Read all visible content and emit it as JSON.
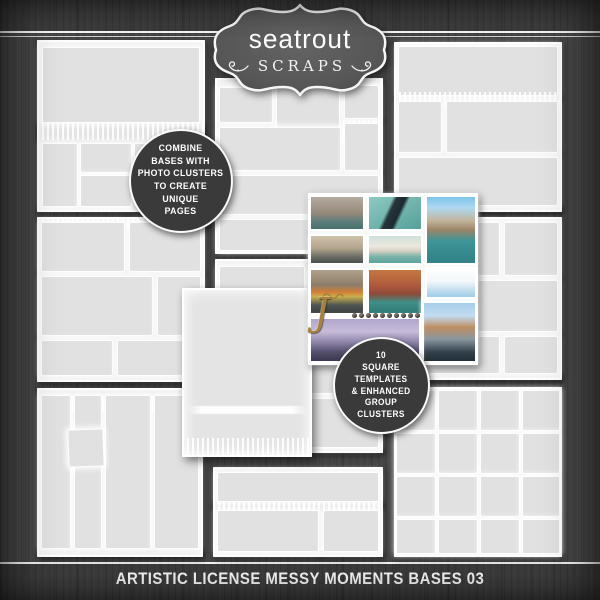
{
  "brand": {
    "name": "seatrout",
    "subname": "SCRAPS"
  },
  "callouts": {
    "left": {
      "lines": [
        "COMBINE",
        "BASES WITH",
        "PHOTO CLUSTERS",
        "TO CREATE",
        "UNIQUE",
        "PAGES"
      ]
    },
    "right": {
      "lines": [
        "10",
        "SQUARE",
        "TEMPLATES",
        "& ENHANCED",
        "GROUP",
        "CLUSTERS"
      ]
    }
  },
  "footer": {
    "title": "ARTISTIC LICENSE MESSY MOMENTS BASES 03"
  },
  "cluster": {
    "monogram": "J",
    "photos": [
      {
        "name": "grand-canal-buildings",
        "css": "background:linear-gradient(180deg,#b3aca0 0%,#96897a 50%,#5e7e7c 75%,#47706e 100%)"
      },
      {
        "name": "gondola-top-view",
        "css": "background:linear-gradient(115deg,rgba(0,0,0,0) 36%,#27343a 42%,#1d2a31 56%,rgba(0,0,0,0) 62%),linear-gradient(150deg,#8ec9c2,#55a099)"
      },
      {
        "name": "rialto-bridge-sky",
        "css": "background:linear-gradient(180deg,#7ec3ea 0%,#aed9f1 16%,#c2b49b 36%,#9b8468 50%,#3f9598 66%,#2f8184 100%)"
      },
      {
        "name": "canal-street-boats",
        "css": "background:linear-gradient(180deg,#cfc2ab 0%,#b3a58d 45%,#6f6f66 75%,#474f4e 100%)"
      },
      {
        "name": "salute-church",
        "css": "background:linear-gradient(180deg,#cfe0da 0%,#ece8df 38%,#d8d2c4 55%,#7cb4ab 75%,#5ba49b 100%)"
      },
      {
        "name": "market-boats-bridge",
        "css": "background:linear-gradient(180deg,#b0a18b 0%,#8c7d6a 35%,#d57f35 52%,#c7b04e 62%,#4d5350 82%,#3a413f 100%)"
      },
      {
        "name": "colorful-canal-houses",
        "css": "background:linear-gradient(180deg,#c4793f 0%,#b05a3e 35%,#8e4a38 55%,#3f8e88 75%,#2f7a75 100%)"
      },
      {
        "name": "white-wash-sky",
        "css": "background:linear-gradient(180deg,#ffffff 0%,#f2f7fa 45%,#c3ddee 75%,#9ecbe8 100%)"
      },
      {
        "name": "gondolas-waterfront",
        "css": "background:linear-gradient(180deg,#a7cdea 0%,#c2dcf0 22%,#bd8e62 42%,#8a97a0 62%,#31404a 85%,#222f38 100%)"
      },
      {
        "name": "lavender-lagoon-dusk",
        "css": "background:linear-gradient(180deg,#b0a6cc 0%,#c7bcd8 30%,#9a90b5 50%,#55506e 78%,#3a3750 100%)"
      }
    ]
  },
  "colors": {
    "background": "#464646",
    "band": "#3c3c3c",
    "page_gray": "#e4e4e4",
    "stroke_white": "#ffffff",
    "badge_fill": "#3a3a3a",
    "plaque_fill": "#5a5a5a",
    "accent_gold": "#a5823f",
    "text_white": "#f3f3f3"
  }
}
